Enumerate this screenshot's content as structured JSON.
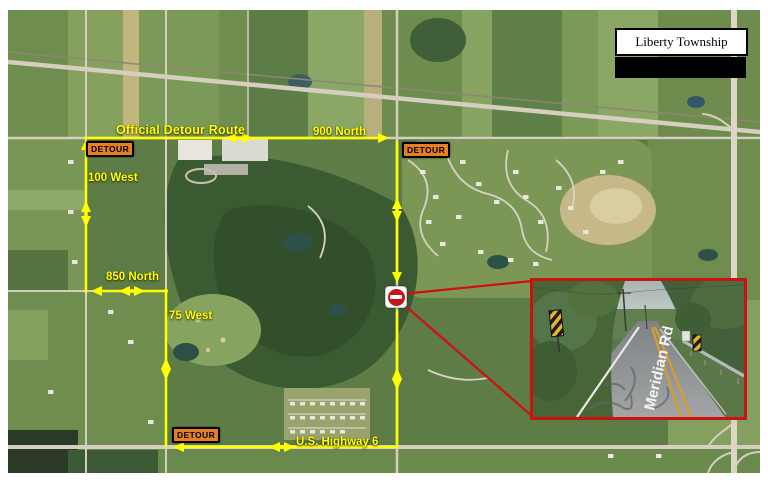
{
  "township": {
    "name": "Liberty Township"
  },
  "detour": {
    "title": "Official Detour Route",
    "signs": [
      {
        "label": "DETOUR"
      },
      {
        "label": "DETOUR"
      },
      {
        "label": "DETOUR"
      }
    ],
    "route_color": "#ffff00",
    "sign_bg_color": "#e87e24",
    "sign_text_color": "#000000"
  },
  "roads": {
    "north_900": "900 North",
    "west_100": "100 West",
    "north_850": "850 North",
    "west_75": "75 West",
    "us_hwy_6": "U.S. Highway 6"
  },
  "closure": {
    "marker": "do-not-enter-road-closed",
    "color": "#c41616"
  },
  "inset": {
    "road_name": "Meridian Rd",
    "border_color": "#cc1111"
  }
}
